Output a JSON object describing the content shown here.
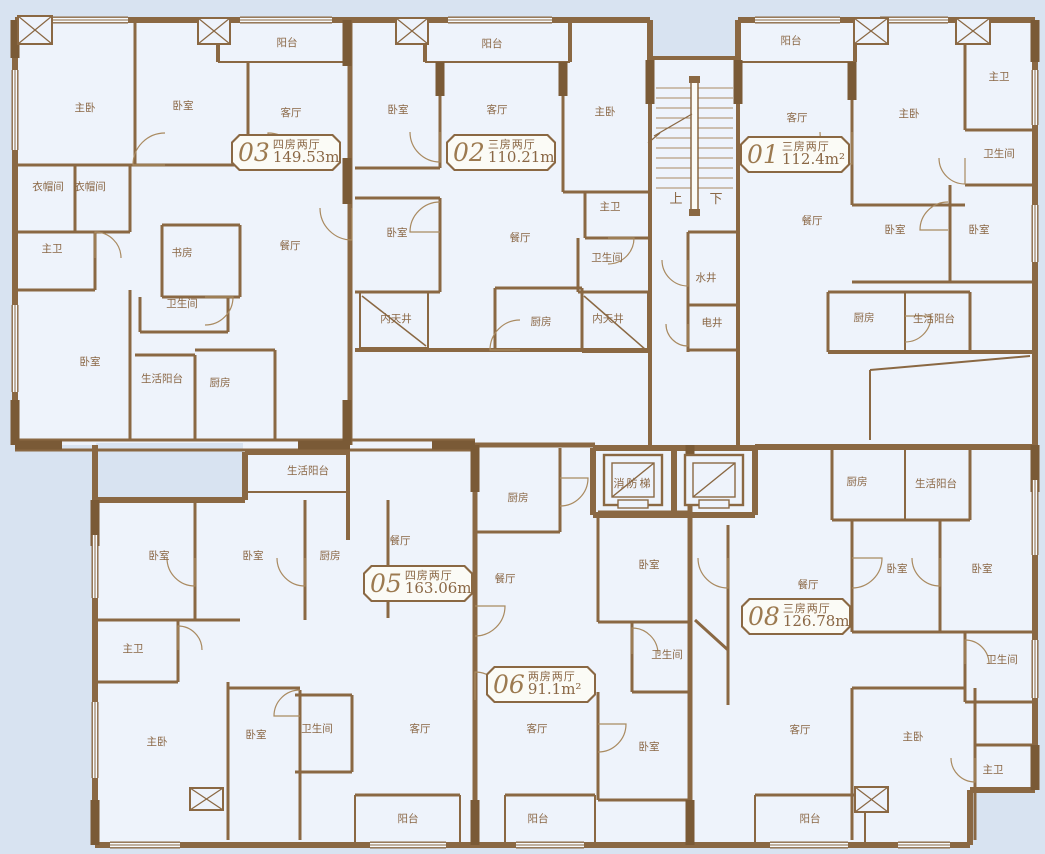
{
  "palette": {
    "background": "#d8e3f1",
    "floor": "#eef3fb",
    "wall": "#8a6843",
    "wall_dark": "#7a5a36",
    "wall_light": "#a98a60",
    "text": "#8a6745",
    "unit_number": "#9c7a50",
    "box_fill": "#fbfbf6"
  },
  "core": {
    "stair_up": "上",
    "stair_down": "下",
    "water_well": "水井",
    "electric_well": "电井",
    "fire_elevator": "消防梯"
  },
  "units": [
    {
      "id": "01",
      "number": "01",
      "layout": "三房两厅",
      "area": "112.4m²",
      "box": {
        "x": 740,
        "y": 136
      },
      "rooms": [
        {
          "t": "阳台",
          "x": 791,
          "y": 40
        },
        {
          "t": "客厅",
          "x": 797,
          "y": 117
        },
        {
          "t": "主卧",
          "x": 909,
          "y": 113
        },
        {
          "t": "主卫",
          "x": 999,
          "y": 76
        },
        {
          "t": "卫生间",
          "x": 999,
          "y": 153
        },
        {
          "t": "餐厅",
          "x": 812,
          "y": 220
        },
        {
          "t": "卧室",
          "x": 895,
          "y": 229
        },
        {
          "t": "卧室",
          "x": 979,
          "y": 229
        },
        {
          "t": "厨房",
          "x": 864,
          "y": 317
        },
        {
          "t": "生活阳台",
          "x": 934,
          "y": 318
        }
      ]
    },
    {
      "id": "02",
      "number": "02",
      "layout": "三房两厅",
      "area": "110.21m²",
      "box": {
        "x": 446,
        "y": 134
      },
      "rooms": [
        {
          "t": "阳台",
          "x": 492,
          "y": 43
        },
        {
          "t": "卧室",
          "x": 398,
          "y": 109
        },
        {
          "t": "客厅",
          "x": 497,
          "y": 109
        },
        {
          "t": "主卧",
          "x": 605,
          "y": 111
        },
        {
          "t": "卧室",
          "x": 397,
          "y": 232
        },
        {
          "t": "主卫",
          "x": 610,
          "y": 206
        },
        {
          "t": "餐厅",
          "x": 520,
          "y": 237
        },
        {
          "t": "卫生间",
          "x": 607,
          "y": 257
        },
        {
          "t": "内天井",
          "x": 396,
          "y": 318
        },
        {
          "t": "厨房",
          "x": 541,
          "y": 321
        },
        {
          "t": "内天井",
          "x": 608,
          "y": 318
        }
      ]
    },
    {
      "id": "03",
      "number": "03",
      "layout": "四房两厅",
      "area": "149.53m²",
      "box": {
        "x": 231,
        "y": 134
      },
      "rooms": [
        {
          "t": "阳台",
          "x": 287,
          "y": 42
        },
        {
          "t": "主卧",
          "x": 85,
          "y": 107
        },
        {
          "t": "卧室",
          "x": 183,
          "y": 105
        },
        {
          "t": "客厅",
          "x": 291,
          "y": 112
        },
        {
          "t": "衣帽间",
          "x": 48,
          "y": 186
        },
        {
          "t": "衣帽间",
          "x": 90,
          "y": 186
        },
        {
          "t": "主卫",
          "x": 52,
          "y": 248
        },
        {
          "t": "书房",
          "x": 182,
          "y": 252
        },
        {
          "t": "餐厅",
          "x": 290,
          "y": 245
        },
        {
          "t": "卫生间",
          "x": 182,
          "y": 303
        },
        {
          "t": "卧室",
          "x": 90,
          "y": 361
        },
        {
          "t": "生活阳台",
          "x": 162,
          "y": 378
        },
        {
          "t": "厨房",
          "x": 220,
          "y": 382
        }
      ]
    },
    {
      "id": "05",
      "number": "05",
      "layout": "四房两厅",
      "area": "163.06m²",
      "box": {
        "x": 363,
        "y": 565
      },
      "rooms": [
        {
          "t": "生活阳台",
          "x": 308,
          "y": 470
        },
        {
          "t": "卧室",
          "x": 159,
          "y": 555
        },
        {
          "t": "卧室",
          "x": 253,
          "y": 555
        },
        {
          "t": "厨房",
          "x": 330,
          "y": 555
        },
        {
          "t": "餐厅",
          "x": 400,
          "y": 540
        },
        {
          "t": "主卫",
          "x": 133,
          "y": 648
        },
        {
          "t": "主卧",
          "x": 157,
          "y": 741
        },
        {
          "t": "卧室",
          "x": 256,
          "y": 734
        },
        {
          "t": "卫生间",
          "x": 317,
          "y": 728
        },
        {
          "t": "客厅",
          "x": 420,
          "y": 728
        },
        {
          "t": "阳台",
          "x": 408,
          "y": 818
        }
      ]
    },
    {
      "id": "06",
      "number": "06",
      "layout": "两房两厅",
      "area": "91.1m²",
      "box": {
        "x": 486,
        "y": 666
      },
      "rooms": [
        {
          "t": "厨房",
          "x": 518,
          "y": 497
        },
        {
          "t": "餐厅",
          "x": 505,
          "y": 578
        },
        {
          "t": "卧室",
          "x": 649,
          "y": 564
        },
        {
          "t": "卫生间",
          "x": 667,
          "y": 654
        },
        {
          "t": "卧室",
          "x": 649,
          "y": 746
        },
        {
          "t": "客厅",
          "x": 537,
          "y": 728
        },
        {
          "t": "阳台",
          "x": 538,
          "y": 818
        }
      ]
    },
    {
      "id": "08",
      "number": "08",
      "layout": "三房两厅",
      "area": "126.78m²",
      "box": {
        "x": 741,
        "y": 598
      },
      "rooms": [
        {
          "t": "餐厅",
          "x": 808,
          "y": 584
        },
        {
          "t": "厨房",
          "x": 857,
          "y": 481
        },
        {
          "t": "生活阳台",
          "x": 936,
          "y": 483
        },
        {
          "t": "卧室",
          "x": 897,
          "y": 568
        },
        {
          "t": "卧室",
          "x": 982,
          "y": 568
        },
        {
          "t": "卫生间",
          "x": 1002,
          "y": 659
        },
        {
          "t": "客厅",
          "x": 800,
          "y": 729
        },
        {
          "t": "主卧",
          "x": 913,
          "y": 736
        },
        {
          "t": "主卫",
          "x": 993,
          "y": 769
        },
        {
          "t": "阳台",
          "x": 810,
          "y": 818
        }
      ]
    }
  ]
}
